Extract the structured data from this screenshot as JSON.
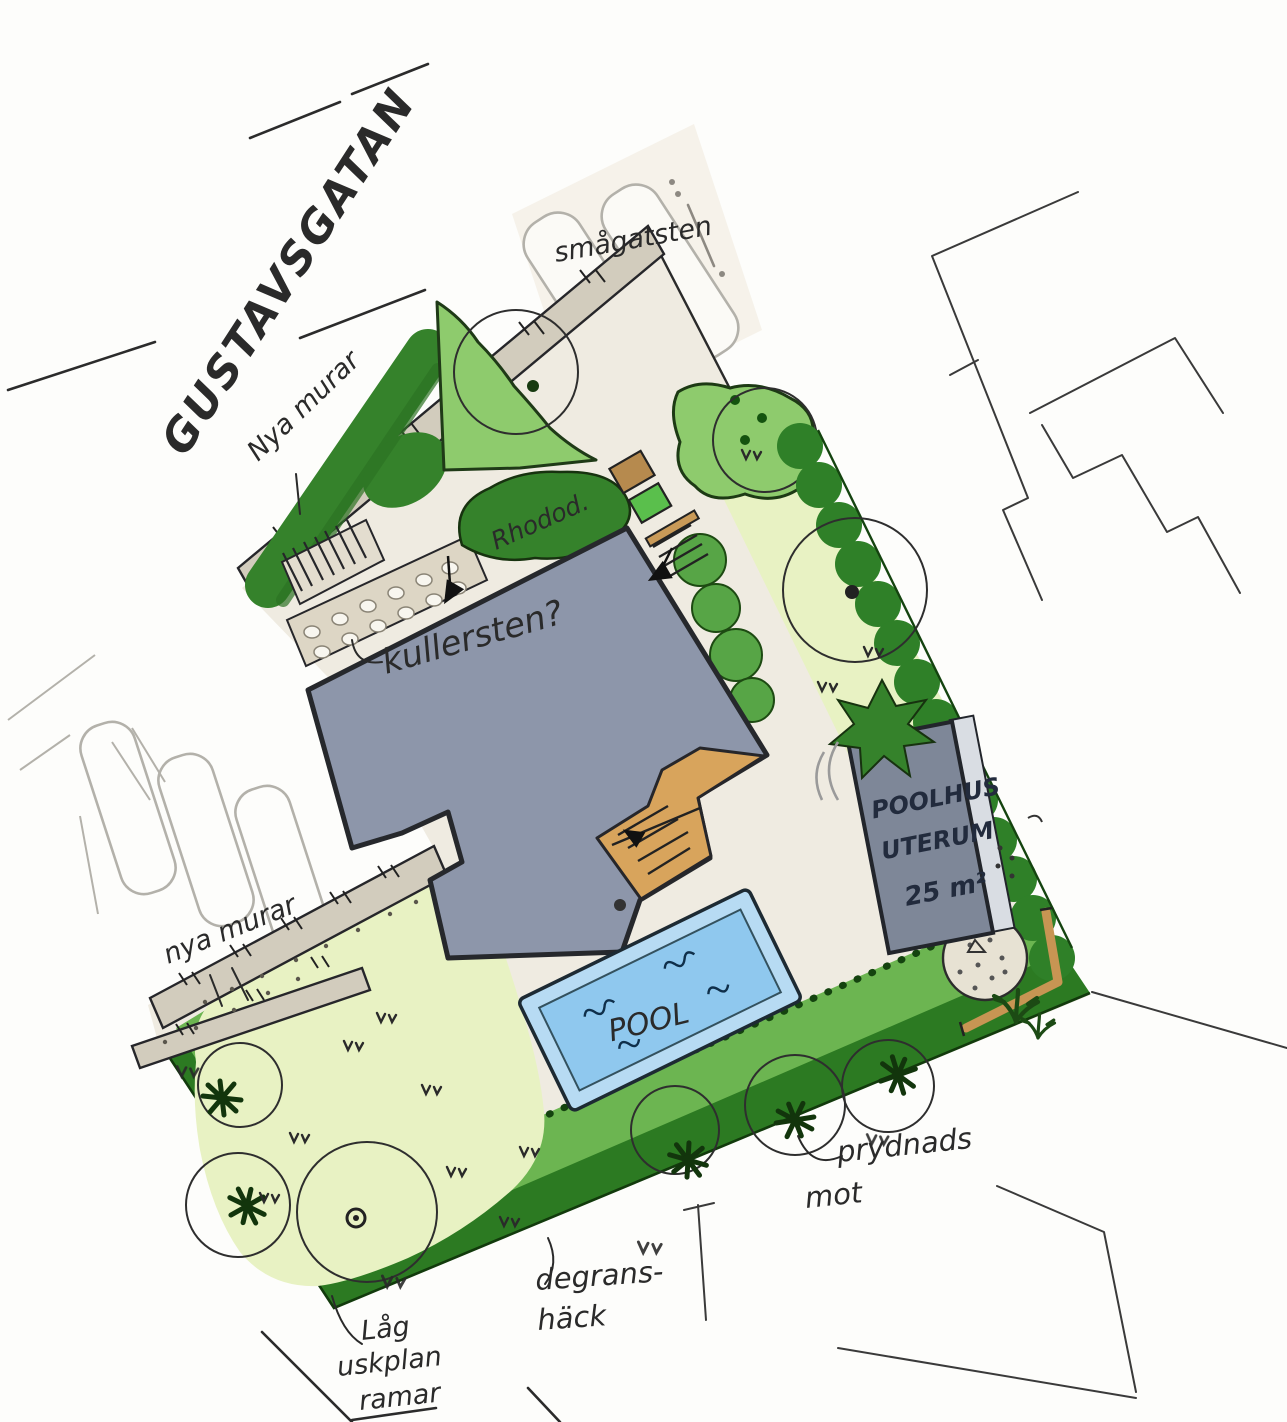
{
  "labels": {
    "street": "GUSTAVSGATAN",
    "new_walls_top": "Nya murar",
    "paving_parking": "smågatsten",
    "cobblestone_question": "kullersten?",
    "rhododendron": "Rhodod.",
    "poolhouse_line1": "POOLHUS",
    "poolhouse_line2": "UTERUM",
    "poolhouse_area": "25 m²",
    "pool": "POOL",
    "new_walls_left": "nya murar",
    "ornamental_line1": "prydnads",
    "ornamental_line2": "mot",
    "hedge_line1": "degrans-",
    "hedge_line2": "häck",
    "low_planting_line1": "Låg",
    "low_planting_line2": "uskplan",
    "low_planting_line3": "ramar"
  },
  "colors": {
    "paper": "#fdfdfb",
    "ink": "#2a2a2a",
    "pencil": "#b3b1aa",
    "ground": "#efebe1",
    "house": "#8d96aa",
    "house_line": "#26282c",
    "deck": "#d8a45c",
    "wood": "#c79553",
    "wall": "#d2ccbd",
    "cobble": "#ddd6c5",
    "gravel": "#e7e2d3",
    "lawn": "#e8f2c3",
    "hedge": "#6cb551",
    "hedge_dark": "#2c7a22",
    "hedge_deep": "#2f8028",
    "bush": "#8ecb6d",
    "bush_dark": "#35822b",
    "pool": "#8fc8ee",
    "pool_rim": "#b7dbf3",
    "poolhouse": "#7e8798",
    "glass": "#d9dde3",
    "grass_pad": "#5abf4c"
  }
}
